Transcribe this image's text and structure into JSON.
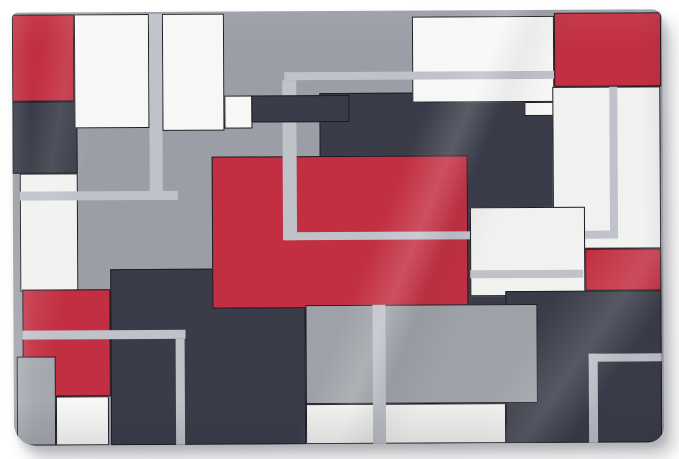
{
  "page": {
    "background": "#ffffff"
  },
  "artwork": {
    "kind": "geometric-abstract-tapestry",
    "palette": {
      "red": "#c22f42",
      "navy": "#3a3d49",
      "grayBase": "#9b9ea6",
      "grayMid": "#9ea1a7",
      "grayStrip": "#a4a7ae",
      "stripe": "#bfc2c9",
      "white": "#f7f7f5",
      "whiteSoft": "#f1f1ef",
      "border": "#1b1c22"
    },
    "canvas": {
      "left": 13,
      "top": 11,
      "width": 650,
      "height": 433,
      "background": "grayBase"
    },
    "shapes": [
      {
        "name": "red-top-left",
        "x": 0,
        "y": 2,
        "w": 62,
        "h": 87,
        "color": "red",
        "border": true
      },
      {
        "name": "navy-left",
        "x": 0,
        "y": 89,
        "w": 65,
        "h": 72,
        "color": "navy",
        "border": true
      },
      {
        "name": "white-left-strip",
        "x": 7,
        "y": 161,
        "w": 58,
        "h": 118,
        "color": "whiteSoft",
        "border": true
      },
      {
        "name": "white-top-left",
        "x": 62,
        "y": 2,
        "w": 75,
        "h": 114,
        "color": "white",
        "border": true
      },
      {
        "name": "white-top-second",
        "x": 150,
        "y": 2,
        "w": 62,
        "h": 117,
        "color": "white",
        "border": true
      },
      {
        "name": "white-top-notch",
        "x": 212,
        "y": 84,
        "w": 28,
        "h": 33,
        "color": "white",
        "border": true
      },
      {
        "name": "navy-central",
        "x": 307,
        "y": 82,
        "w": 237,
        "h": 219,
        "color": "navy",
        "border": true
      },
      {
        "name": "navy-lower-left",
        "x": 97,
        "y": 257,
        "w": 195,
        "h": 176,
        "color": "navy",
        "border": true
      },
      {
        "name": "red-center-large",
        "x": 199,
        "y": 145,
        "w": 256,
        "h": 152,
        "color": "red",
        "border": true
      },
      {
        "name": "white-top-center",
        "x": 400,
        "y": 6,
        "w": 142,
        "h": 86,
        "color": "white",
        "border": true
      },
      {
        "name": "white-top-center-step",
        "x": 512,
        "y": 92,
        "w": 30,
        "h": 14,
        "color": "white",
        "border": true
      },
      {
        "name": "white-right-large",
        "x": 540,
        "y": 77,
        "w": 108,
        "h": 162,
        "color": "whiteSoft",
        "border": true
      },
      {
        "name": "outline-square-top",
        "x": 272,
        "y": 61,
        "w": 333,
        "h": 8,
        "color": "stripe",
        "border": false
      },
      {
        "name": "outline-square-left-upper",
        "x": 270,
        "y": 69,
        "w": 14,
        "h": 16,
        "color": "stripe",
        "border": false
      },
      {
        "name": "outline-square-left",
        "x": 270,
        "y": 109,
        "w": 14,
        "h": 120,
        "color": "stripe",
        "border": false
      },
      {
        "name": "outline-square-bottom",
        "x": 272,
        "y": 221,
        "w": 333,
        "h": 8,
        "color": "stripe",
        "border": false
      },
      {
        "name": "outline-square-right",
        "x": 597,
        "y": 69,
        "w": 8,
        "h": 160,
        "color": "stripe",
        "border": false
      },
      {
        "name": "stripe-left-vertical",
        "x": 137,
        "y": 2,
        "w": 13,
        "h": 186,
        "color": "stripe",
        "border": false
      },
      {
        "name": "stripe-left-horizontal",
        "x": 7,
        "y": 179,
        "w": 158,
        "h": 9,
        "color": "stripe",
        "border": false
      },
      {
        "name": "navy-top-bar",
        "x": 239,
        "y": 84,
        "w": 98,
        "h": 27,
        "color": "navy",
        "border": true
      },
      {
        "name": "red-top-right",
        "x": 542,
        "y": 3,
        "w": 107,
        "h": 74,
        "color": "red",
        "border": true
      },
      {
        "name": "red-right-mid",
        "x": 572,
        "y": 239,
        "w": 76,
        "h": 42,
        "color": "red",
        "border": true
      },
      {
        "name": "white-mid-right",
        "x": 457,
        "y": 197,
        "w": 115,
        "h": 89,
        "color": "whiteSoft",
        "border": true
      },
      {
        "name": "stripe-on-white-mid",
        "x": 457,
        "y": 260,
        "w": 113,
        "h": 8,
        "color": "stripe",
        "border": false
      },
      {
        "name": "red-lower-left",
        "x": 9,
        "y": 277,
        "w": 88,
        "h": 107,
        "color": "red",
        "border": true
      },
      {
        "name": "gray-strip-bottom-left",
        "x": 3,
        "y": 344,
        "w": 39,
        "h": 89,
        "color": "grayStrip",
        "border": true
      },
      {
        "name": "white-square-bottom-left",
        "x": 42,
        "y": 384,
        "w": 53,
        "h": 49,
        "color": "white",
        "border": true
      },
      {
        "name": "navy-bottom-right",
        "x": 492,
        "y": 281,
        "w": 156,
        "h": 152,
        "color": "navy",
        "border": true
      },
      {
        "name": "gray-rect-bottom",
        "x": 292,
        "y": 294,
        "w": 232,
        "h": 99,
        "color": "grayMid",
        "border": true
      },
      {
        "name": "white-strip-bottom",
        "x": 292,
        "y": 393,
        "w": 200,
        "h": 40,
        "color": "whiteSoft",
        "border": true
      },
      {
        "name": "corner-stripe-ll-horizontal",
        "x": 9,
        "y": 318,
        "w": 163,
        "h": 9,
        "color": "stripe",
        "border": false
      },
      {
        "name": "corner-stripe-ll-vertical",
        "x": 162,
        "y": 327,
        "w": 9,
        "h": 106,
        "color": "stripe",
        "border": false
      },
      {
        "name": "stripe-bottom-vertical",
        "x": 359,
        "y": 294,
        "w": 13,
        "h": 139,
        "color": "stripe",
        "border": false
      },
      {
        "name": "corner-stripe-br-horizontal",
        "x": 575,
        "y": 344,
        "w": 73,
        "h": 8,
        "color": "stripe",
        "border": false
      },
      {
        "name": "corner-stripe-br-vertical",
        "x": 575,
        "y": 344,
        "w": 9,
        "h": 89,
        "color": "stripe",
        "border": false
      }
    ]
  }
}
